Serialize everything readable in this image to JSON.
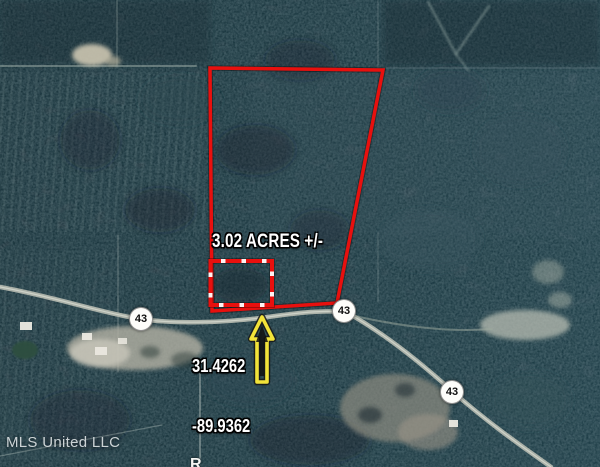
{
  "map": {
    "acreage_label": "3.02 ACRES +/-",
    "coordinates": {
      "latitude": "31.4262",
      "longitude": "-89.9362"
    },
    "route_shields": [
      {
        "label": "43"
      },
      {
        "label": "43"
      },
      {
        "label": "43"
      }
    ],
    "watermark": "MLS United LLC",
    "partial_glyph": "R",
    "colors": {
      "parcel_outline": "#e8100e",
      "location_arrow": "#f2e339",
      "annotation_text": "#ffffff",
      "shield_background": "#fdfdfa",
      "shield_text": "#101010"
    }
  }
}
